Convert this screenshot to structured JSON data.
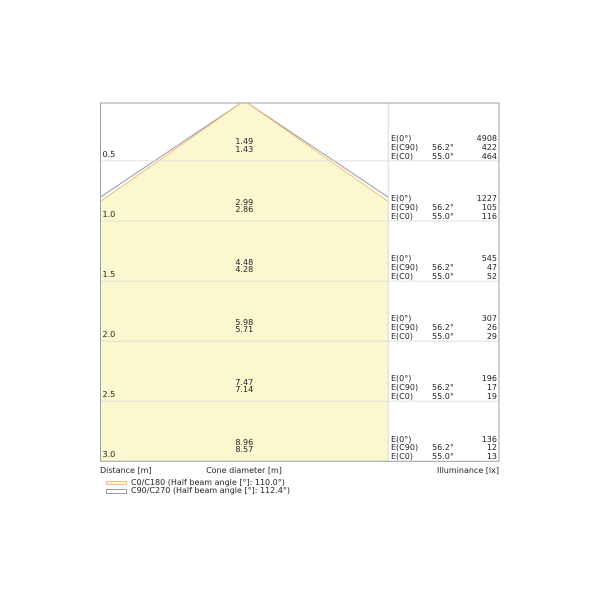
{
  "colors": {
    "cone_fill": "#FBF8D0",
    "c0_c180_line": "#EFBC8A",
    "c90_c270_line": "#9B9B9B",
    "grid_line": "#D9D9D9",
    "divider_line": "#CFCFCF",
    "border": "#A0A0A0",
    "text": "#222222"
  },
  "axis": {
    "distance": "Distance [m]",
    "cone_diameter": "Cone diameter [m]",
    "illuminance": "Illuminance [lx]"
  },
  "e_labels": {
    "e0": "E(0°)",
    "ec90": "E(C90)",
    "ec0": "E(C0)",
    "ec90_angle": "56.2°",
    "ec0_angle": "55.0°"
  },
  "legend": {
    "items": [
      {
        "label": "C0/C180 (Half beam angle [°]: 110.0°)"
      },
      {
        "label": "C90/C270 (Half beam angle [°]: 112.4°)"
      }
    ]
  },
  "rows": [
    {
      "distance": "0.5",
      "diam_c90": "1.49",
      "diam_c0": "1.43",
      "e0": "4908",
      "ec90": "422",
      "ec0": "464"
    },
    {
      "distance": "1.0",
      "diam_c90": "2.99",
      "diam_c0": "2.86",
      "e0": "1227",
      "ec90": "105",
      "ec0": "116"
    },
    {
      "distance": "1.5",
      "diam_c90": "4.48",
      "diam_c0": "4.28",
      "e0": "545",
      "ec90": "47",
      "ec0": "52"
    },
    {
      "distance": "2.0",
      "diam_c90": "5.98",
      "diam_c0": "5.71",
      "e0": "307",
      "ec90": "26",
      "ec0": "29"
    },
    {
      "distance": "2.5",
      "diam_c90": "7.47",
      "diam_c0": "7.14",
      "e0": "196",
      "ec90": "17",
      "ec0": "19"
    },
    {
      "distance": "3.0",
      "diam_c90": "8.96",
      "diam_c0": "8.57",
      "e0": "136",
      "ec90": "12",
      "ec0": "13"
    }
  ],
  "chart_data": {
    "type": "area",
    "title": "Light cone diagram (luminaire photometrics)",
    "xlabel": "Cone diameter [m]",
    "ylabel": "Distance [m]",
    "ylabel_right": "Illuminance [lx]",
    "ylim": [
      0,
      3.0
    ],
    "grid": true,
    "legend_position": "bottom-left",
    "distances_m": [
      0.5,
      1.0,
      1.5,
      2.0,
      2.5,
      3.0
    ],
    "series": [
      {
        "name": "C0/C180 (Half beam angle [°]: 110.0°)",
        "half_beam_angle_deg": 110.0,
        "color": "#EFBC8A",
        "cone_diameter_m": [
          1.43,
          2.86,
          4.28,
          5.71,
          7.14,
          8.57
        ]
      },
      {
        "name": "C90/C270 (Half beam angle [°]: 112.4°)",
        "half_beam_angle_deg": 112.4,
        "color": "#9B9B9B",
        "cone_diameter_m": [
          1.49,
          2.99,
          4.48,
          5.98,
          7.47,
          8.96
        ]
      }
    ],
    "illuminance_lx": {
      "E0_deg": [
        4908,
        1227,
        545,
        307,
        196,
        136
      ],
      "EC90_angle": "56.2°",
      "EC90": [
        422,
        105,
        47,
        26,
        17,
        12
      ],
      "EC0_angle": "55.0°",
      "EC0": [
        464,
        116,
        52,
        29,
        19,
        13
      ]
    }
  }
}
